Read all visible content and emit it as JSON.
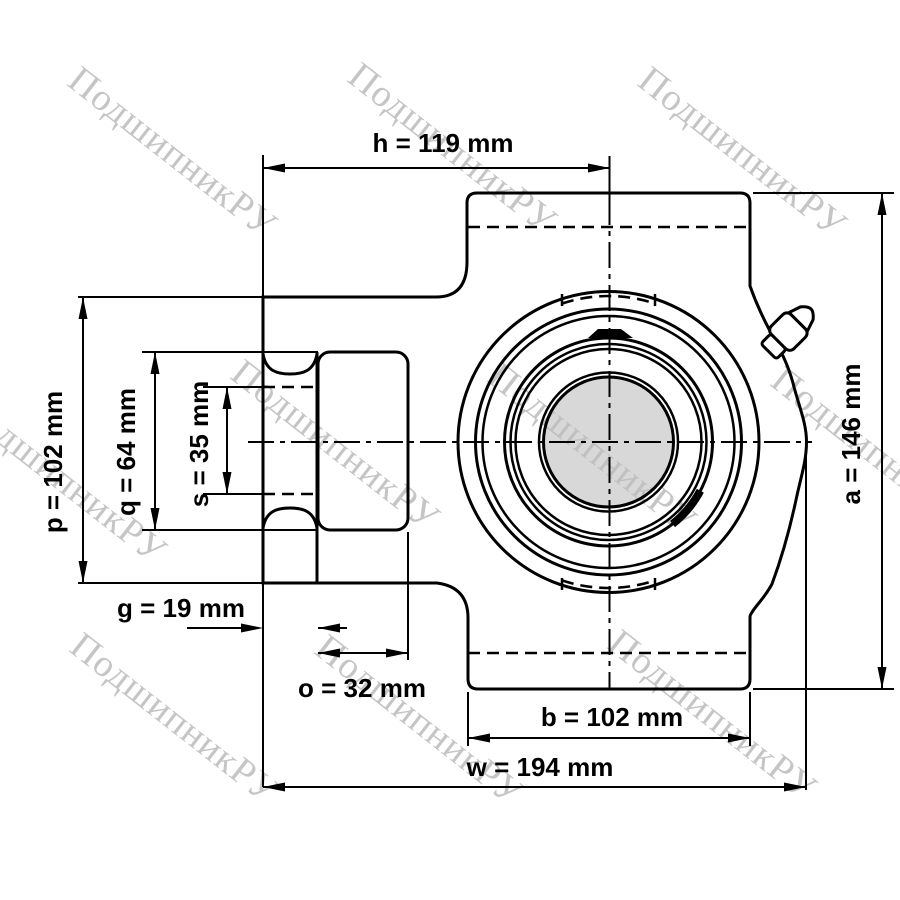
{
  "drawing": {
    "title": "take-up bearing unit technical drawing",
    "units": "mm",
    "watermark": {
      "text": "ПодшипникРУ",
      "color": "#bcbcbc"
    },
    "colors": {
      "line": "#000000",
      "background": "#ffffff",
      "shaft_fill": "#d8d8d8"
    },
    "dimensions": [
      {
        "id": "h",
        "label": "h = 119 mm",
        "value_mm": 119
      },
      {
        "id": "p",
        "label": "p = 102 mm",
        "value_mm": 102
      },
      {
        "id": "q",
        "label": "q = 64 mm",
        "value_mm": 64
      },
      {
        "id": "s",
        "label": "s = 35 mm",
        "value_mm": 35
      },
      {
        "id": "g",
        "label": "g = 19 mm",
        "value_mm": 19
      },
      {
        "id": "o",
        "label": "o = 32 mm",
        "value_mm": 32
      },
      {
        "id": "b",
        "label": "b = 102 mm",
        "value_mm": 102
      },
      {
        "id": "w",
        "label": "w = 194 mm",
        "value_mm": 194
      },
      {
        "id": "a",
        "label": "a = 146 mm",
        "value_mm": 146
      }
    ]
  }
}
